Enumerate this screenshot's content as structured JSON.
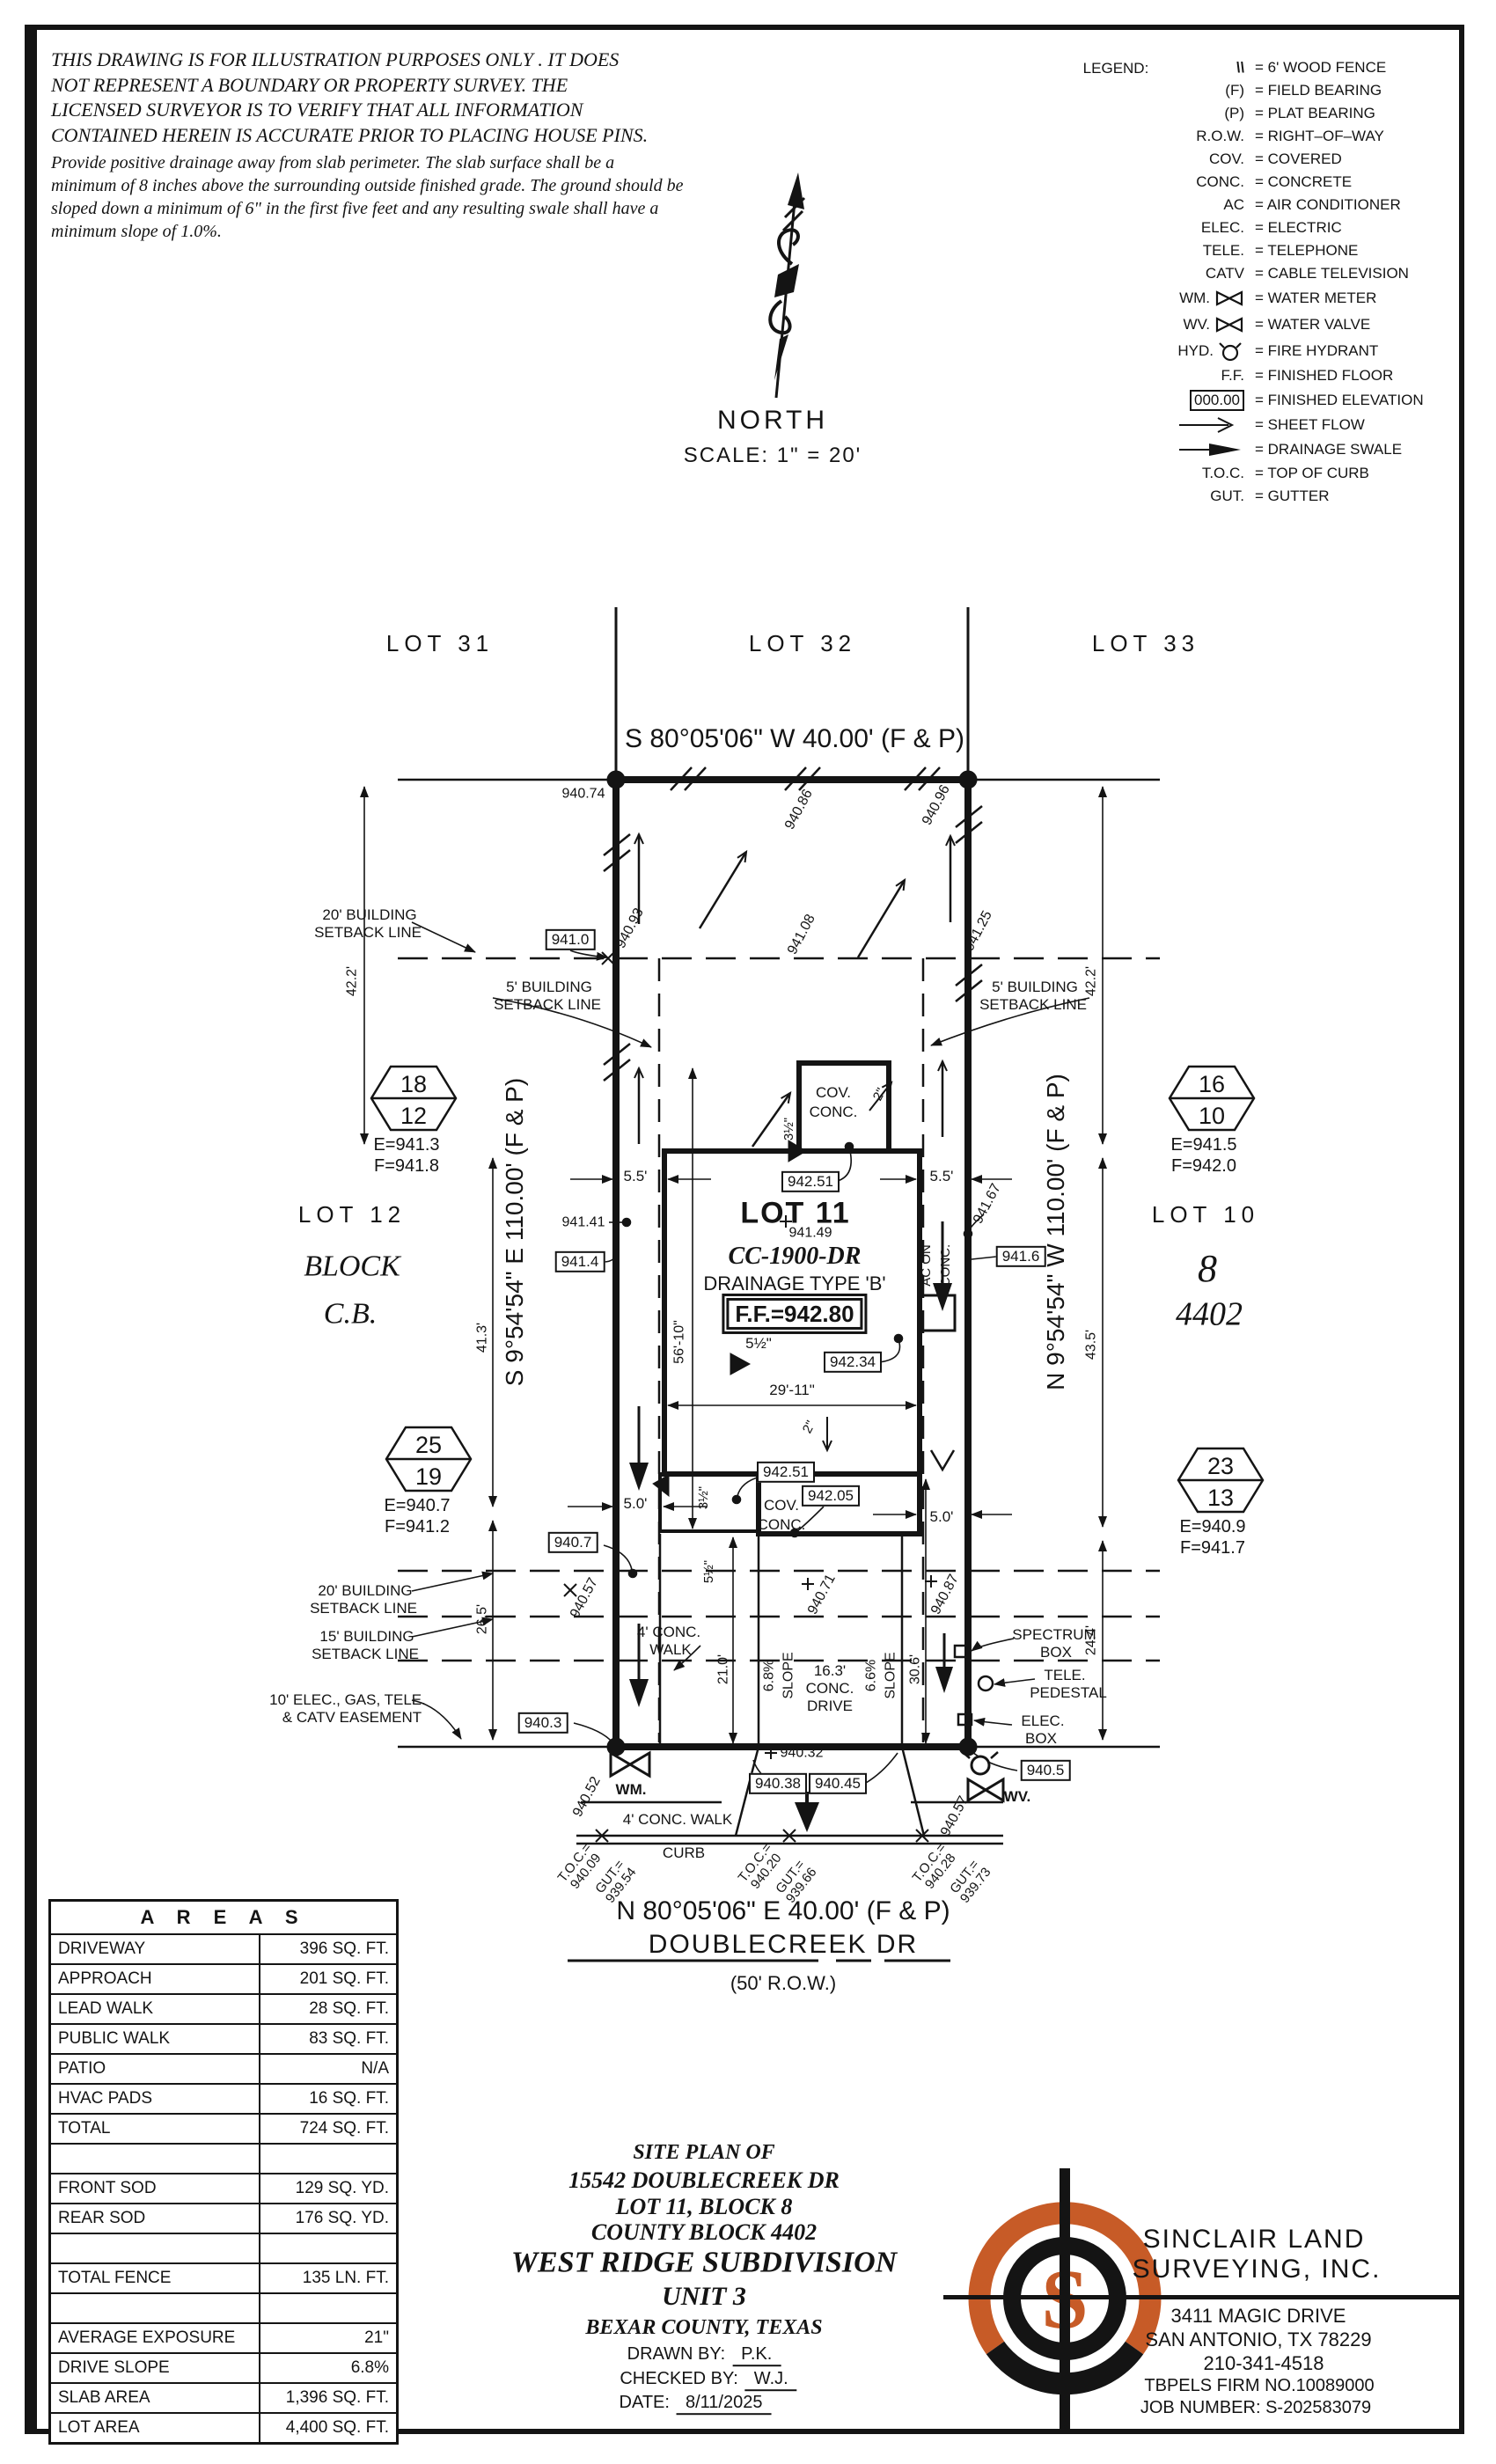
{
  "disclaimer": {
    "lines": [
      "THIS DRAWING IS FOR ILLUSTRATION PURPOSES ONLY . IT DOES",
      "NOT REPRESENT A BOUNDARY OR PROPERTY SURVEY. THE",
      "LICENSED SURVEYOR IS TO VERIFY THAT ALL INFORMATION",
      "CONTAINED HEREIN IS ACCURATE PRIOR TO PLACING HOUSE PINS."
    ]
  },
  "note": {
    "lines": [
      "Provide positive drainage away from slab perimeter. The slab surface shall be a",
      "minimum of 8 inches above the surrounding outside finished grade. The ground should be",
      "sloped down a minimum of 6\" in the first five feet and any resulting swale shall have a",
      "minimum slope of 1.0%."
    ]
  },
  "north": {
    "label": "NORTH",
    "scale": "SCALE:  1\" =  20'"
  },
  "legend": {
    "title": "LEGEND:",
    "rows": [
      {
        "sym": "\\\\",
        "desc": "=  6'  WOOD FENCE"
      },
      {
        "sym": "(F)",
        "desc": "=  FIELD BEARING"
      },
      {
        "sym": "(P)",
        "desc": "=  PLAT BEARING"
      },
      {
        "sym": "R.O.W.",
        "desc": "=  RIGHT–OF–WAY"
      },
      {
        "sym": "COV.",
        "desc": "=  COVERED"
      },
      {
        "sym": "CONC.",
        "desc": "=  CONCRETE"
      },
      {
        "sym": "AC",
        "desc": "=  AIR CONDITIONER"
      },
      {
        "sym": "ELEC.",
        "desc": "=  ELECTRIC"
      },
      {
        "sym": "TELE.",
        "desc": "=  TELEPHONE"
      },
      {
        "sym": "CATV",
        "desc": "=  CABLE TELEVISION"
      },
      {
        "sym": "WM.",
        "desc": "=  WATER METER"
      },
      {
        "sym": "WV.",
        "desc": "=  WATER VALVE"
      },
      {
        "sym": "HYD.",
        "desc": "=  FIRE HYDRANT"
      },
      {
        "sym": "F.F.",
        "desc": "=  FINISHED FLOOR"
      },
      {
        "sym": "000.00",
        "desc": "=  FINISHED ELEVATION"
      },
      {
        "sym": "",
        "desc": "=  SHEET FLOW"
      },
      {
        "sym": "",
        "desc": "=  DRAINAGE SWALE"
      },
      {
        "sym": "T.O.C.",
        "desc": "=  TOP OF CURB"
      },
      {
        "sym": "GUT.",
        "desc": "=  GUTTER"
      }
    ]
  },
  "neighbors": {
    "lot31": "LOT 31",
    "lot32": "LOT 32",
    "lot33": "LOT 33",
    "lot12": "LOT 12",
    "block": "BLOCK",
    "cb": "C.B.",
    "lot10": "LOT 10",
    "blk8": "8",
    "cb4402": "4402"
  },
  "bearings": {
    "top": "S 80°05'06\" W  40.00'  (F & P)",
    "bottom": "N 80°05'06\" E  40.00'  (F & P)",
    "left": "S 9°54'54\" E  110.00'  (F & P)",
    "right": "N 9°54'54\" W  110.00'  (F & P)",
    "street": "DOUBLECREEK DR",
    "row": "(50' R.O.W.)"
  },
  "markers": {
    "h1812": {
      "top": "18",
      "bottom": "12",
      "e": "E=941.3",
      "f": "F=941.8"
    },
    "h1610": {
      "top": "16",
      "bottom": "10",
      "e": "E=941.5",
      "f": "F=942.0"
    },
    "h2519": {
      "top": "25",
      "bottom": "19",
      "e": "E=940.7",
      "f": "F=941.2"
    },
    "h2313": {
      "top": "23",
      "bottom": "13",
      "e": "E=940.9",
      "f": "F=941.7"
    }
  },
  "house": {
    "lot": "LOT 11",
    "plan_no": "CC-1900-DR",
    "drainage": "DRAINAGE TYPE 'B'",
    "ff": "F.F.=942.80",
    "cov1a": "COV.",
    "cov1b": "CONC.",
    "cov2a": "COV.",
    "cov2b": "CONC.",
    "ac1": "AC ON",
    "ac2": "CONC."
  },
  "dims": {
    "d422l": "42.2'",
    "d422r": "42.2'",
    "d413": "41.3'",
    "d435": "43.5'",
    "d265": "26.5'",
    "d244": "24.4'",
    "d55l": "5.5'",
    "d55r": "5.5'",
    "d50l": "5.0'",
    "d50r": "5.0'",
    "d5610": "56'-10\"",
    "d2911": "29'-11\"",
    "d210": "21.0'",
    "d306": "30.6'",
    "in2a": "2\"",
    "in2b": "2\"",
    "in35a": "3½\"",
    "in35b": "3½\"",
    "in55a": "5½\"",
    "in55b": "5½\""
  },
  "drive": {
    "w": "16.3'",
    "conc": "CONC.",
    "drv": "DRIVE",
    "s1": "6.8%",
    "sl1": "SLOPE",
    "s2": "6.6%",
    "sl2": "SLOPE"
  },
  "elev": {
    "e74": "940.74",
    "e86": "940.86",
    "e96": "940.96",
    "e93": "940.93",
    "e108": "941.08",
    "e125": "941.25",
    "b410": "941.0",
    "e141": "941.41",
    "b414": "941.4",
    "e167": "941.67",
    "b416": "941.6",
    "e149": "941.49",
    "b2511": "942.51",
    "b234": "942.34",
    "b2512": "942.51",
    "b205": "942.05",
    "b407": "940.7",
    "e571": "940.57",
    "e71": "940.71",
    "e87": "940.87",
    "b403": "940.3",
    "e52": "940.52",
    "e32": "940.32",
    "b38": "940.38",
    "b45": "940.45",
    "b405": "940.5",
    "e572": "940.57"
  },
  "setbacks": {
    "t1": "20' BUILDING",
    "t2": "SETBACK LINE",
    "l5a": "5' BUILDING",
    "l5b": "SETBACK LINE",
    "r5a": "5' BUILDING",
    "r5b": "SETBACK LINE",
    "b20a": "20' BUILDING",
    "b20b": "SETBACK LINE",
    "b15a": "15' BUILDING",
    "b15b": "SETBACK LINE",
    "ea": "10' ELEC., GAS, TELE.",
    "eb": "& CATV EASEMENT"
  },
  "site": {
    "walk_a": "4' CONC.",
    "walk_b": "WALK",
    "walk_bottom": "4' CONC. WALK",
    "curb": "CURB",
    "spec_a": "SPECTRUM",
    "spec_b": "BOX",
    "tele_a": "TELE.",
    "tele_b": "PEDESTAL",
    "elec_a": "ELEC.",
    "elec_b": "BOX",
    "wm": "WM.",
    "wv": "WV."
  },
  "toc": {
    "g1": {
      "t": "T.O.C.=",
      "tv": "940.09",
      "g": "GUT.=",
      "gv": "939.54"
    },
    "g2": {
      "t": "T.O.C.=",
      "tv": "940.20",
      "g": "GUT.=",
      "gv": "939.66"
    },
    "g3": {
      "t": "T.O.C.=",
      "tv": "940.28",
      "g": "GUT.=",
      "gv": "939.73"
    }
  },
  "areas": {
    "title": "A R E A S",
    "rows": [
      {
        "label": "DRIVEWAY",
        "value": "396 SQ. FT."
      },
      {
        "label": "APPROACH",
        "value": "201 SQ. FT."
      },
      {
        "label": "LEAD WALK",
        "value": "28 SQ. FT."
      },
      {
        "label": "PUBLIC WALK",
        "value": "83 SQ. FT."
      },
      {
        "label": "PATIO",
        "value": "N/A"
      },
      {
        "label": "HVAC PADS",
        "value": "16 SQ. FT."
      },
      {
        "label": "TOTAL",
        "value": "724 SQ. FT."
      },
      {
        "label": "",
        "value": ""
      },
      {
        "label": "FRONT SOD",
        "value": "129 SQ. YD."
      },
      {
        "label": "REAR SOD",
        "value": "176 SQ. YD."
      },
      {
        "label": "",
        "value": ""
      },
      {
        "label": "TOTAL FENCE",
        "value": "135 LN. FT."
      },
      {
        "label": "",
        "value": ""
      },
      {
        "label": "AVERAGE EXPOSURE",
        "value": "21\""
      },
      {
        "label": "DRIVE SLOPE",
        "value": "6.8%"
      },
      {
        "label": "SLAB AREA",
        "value": "1,396 SQ. FT."
      },
      {
        "label": "LOT AREA",
        "value": "4,400 SQ. FT."
      }
    ]
  },
  "titleblock": {
    "l1": "SITE PLAN OF",
    "l2": "15542 DOUBLECREEK DR",
    "l3": "LOT 11, BLOCK 8",
    "l4": "COUNTY BLOCK 4402",
    "l5": "WEST RIDGE SUBDIVISION",
    "l6": "UNIT 3",
    "l7": "BEXAR COUNTY, TEXAS",
    "drawn_label": "DRAWN BY:",
    "drawn": "P.K.",
    "checked_label": "CHECKED BY:",
    "checked": "W.J.",
    "date_label": "DATE:",
    "date": "8/11/2025"
  },
  "company": {
    "name1": "SINCLAIR LAND",
    "name2": "SURVEYING, INC.",
    "addr1": "3411 MAGIC DRIVE",
    "addr2": "SAN ANTONIO, TX 78229",
    "phone": "210-341-4518",
    "firm": "TBPELS FIRM NO.10089000",
    "job": "JOB NUMBER: S-202583079",
    "logo_letter": "S",
    "accent": "#C75B27"
  }
}
